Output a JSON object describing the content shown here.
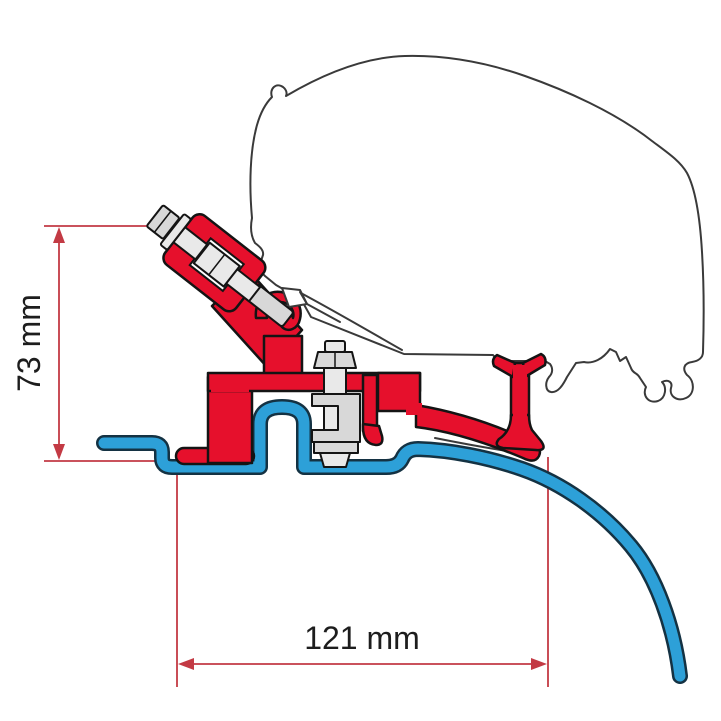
{
  "title": "Awning adapter bracket cross-section diagram",
  "dimensions": {
    "vertical": {
      "label": "73 mm"
    },
    "horizontal": {
      "label": "121 mm"
    }
  },
  "colors": {
    "bracket-red": "#e6102c",
    "profile-blue": "#2da0d8",
    "dimension-red": "#c33a44",
    "outline-gray": "#3a3a3a",
    "metal-light": "#e9e9e9",
    "metal-mid": "#d8d8d8",
    "ink": "#1d1d1d",
    "background": "#ffffff"
  },
  "parts": {
    "awning_case": "awning-case-outline",
    "adapter_bracket": "red-adapter-bracket",
    "roof_profile": "blue-roof-profile",
    "front_bolt": "front-clamp-bolt-assembly",
    "center_bolt": "center-clamp-bolt-assembly",
    "rear_support": "rear-t-support"
  }
}
